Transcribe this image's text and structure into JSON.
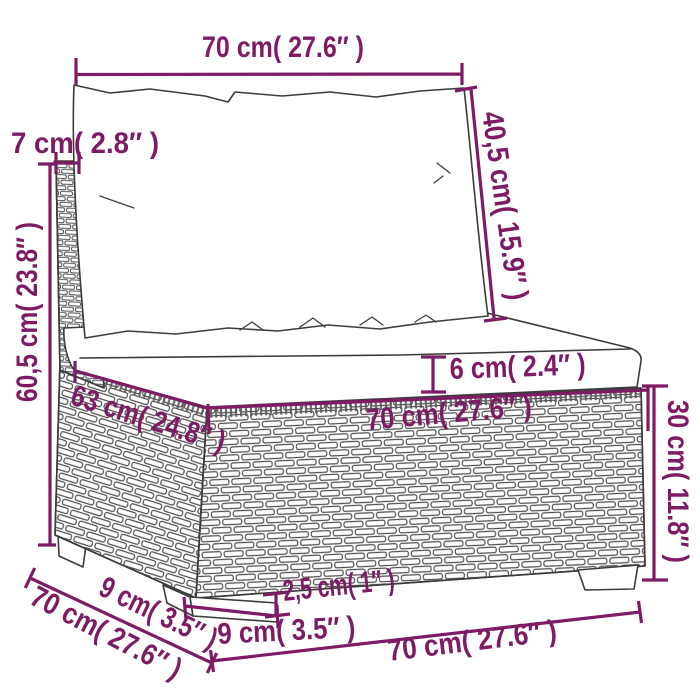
{
  "diagram": {
    "accent_color": "#7D1B64",
    "outline_color": "#3C3C3C",
    "brick_color": "#4F4F4F",
    "labels": {
      "top_width": "70 cm( 27.6″ )",
      "back_cushion_height": "40,5 cm( 15.9″ )",
      "back_thickness": "7 cm( 2.8″ )",
      "total_height": "60,5 cm( 23.8″ )",
      "seat_depth": "63 cm( 24.8″ )",
      "seat_cushion_thickness": "6 cm( 2.4″ )",
      "seat_width": "70 cm( 27.6″ )",
      "base_height": "30 cm( 11.8″ )",
      "total_depth": "70 cm( 27.6″ )",
      "side_foot_depth": "9 cm( 3.5″ )",
      "foot_height": "2,5 cm( 1″ )",
      "front_foot_width": "9 cm( 3.5″ )",
      "bottom_front_width": "70 cm( 27.6″ )"
    }
  }
}
